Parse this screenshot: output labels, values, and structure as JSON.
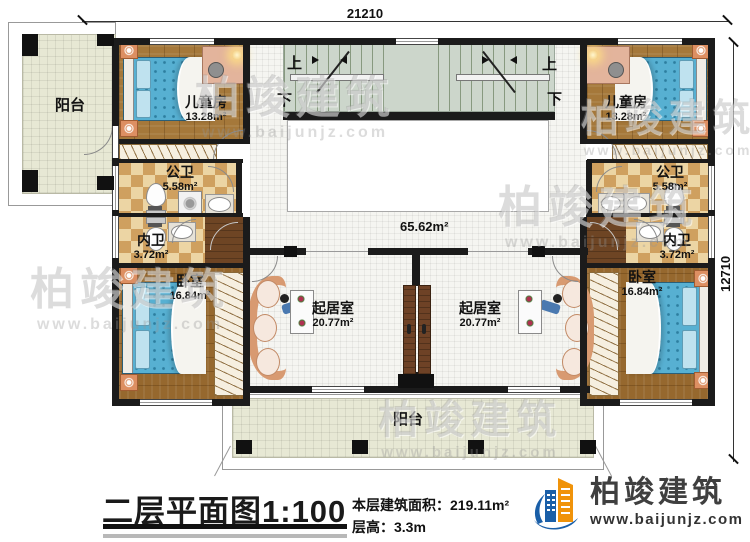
{
  "dimensions": {
    "top_label": "21210",
    "right_label": "12710"
  },
  "title_block": {
    "plan_title": "二层平面图",
    "scale": "1:100",
    "area_label": "本层建筑面积：",
    "area_value": "219.11m²",
    "floor_height_label": "层高：",
    "floor_height_value": "3.3m"
  },
  "logo": {
    "company": "柏竣建筑",
    "website": "www.baijunjz.com"
  },
  "watermark": {
    "text": "柏竣建筑",
    "subtext": "www.baijunjz.com"
  },
  "stairs": {
    "up_label": "上",
    "down_label": "下"
  },
  "rooms": {
    "balcony_left": {
      "name": "阳台"
    },
    "balcony_bottom": {
      "name": "阳台"
    },
    "children_room_left": {
      "name": "儿童房",
      "area": "13.28m²"
    },
    "children_room_right": {
      "name": "儿童房",
      "area": "13.28m²"
    },
    "public_bath_left": {
      "name": "公卫",
      "area": "5.58m²"
    },
    "public_bath_right": {
      "name": "公卫",
      "area": "5.58m²"
    },
    "private_bath_left": {
      "name": "内卫",
      "area": "3.72m²"
    },
    "private_bath_right": {
      "name": "内卫",
      "area": "3.72m²"
    },
    "bedroom_left": {
      "name": "卧室",
      "area": "16.84m²"
    },
    "bedroom_right": {
      "name": "卧室",
      "area": "16.84m²"
    },
    "living_room_left": {
      "name": "起居室",
      "area": "20.77m²"
    },
    "living_room_right": {
      "name": "起居室",
      "area": "20.77m²"
    },
    "hall": {
      "area": "65.62m²"
    }
  },
  "colors": {
    "wall": "#1b1b1b",
    "wood_floor": "#a5783a",
    "bed_blue": "#5cb3d3",
    "bath_tile": "#cfa05f",
    "balcony_tile": "#e7e8d4",
    "stair_green": "#ccd6cb",
    "logo_blue": "#1a5fa8",
    "logo_orange": "#f0930a",
    "logo_text": "#3f3f3f"
  }
}
